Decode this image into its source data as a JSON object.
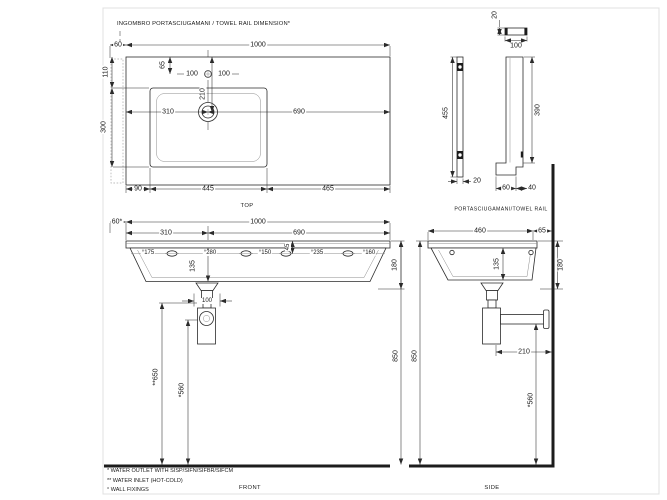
{
  "page": {
    "background": "#ffffff",
    "line_color": "#2b2b2b",
    "wall_color": "#1c1c1c"
  },
  "header": {
    "note": "INGOMBRO PORTASCIUGAMANI / TOWEL RAIL DIMENSION*"
  },
  "views": {
    "top": {
      "caption": "TOP"
    },
    "front": {
      "caption": "FRONT"
    },
    "side": {
      "caption": "SIDE"
    },
    "towel_rail": {
      "caption": "PORTASCIUGAMANI/TOWEL RAIL"
    }
  },
  "footnotes": [
    "* WATER OUTLET WITH SISP/SIFN/SIFBR/SIFCM",
    "** WATER INLET  (HOT-COLD)",
    "° WALL FIXINGS"
  ],
  "annotations": [
    {
      "t": "60",
      "x": 118,
      "y": 45
    },
    {
      "t": "1000",
      "x": 258,
      "y": 45
    },
    {
      "t": "110",
      "x": 106,
      "y": 72,
      "r": -90
    },
    {
      "t": "65",
      "x": 163,
      "y": 65,
      "r": -90
    },
    {
      "t": "100",
      "x": 192,
      "y": 74
    },
    {
      "t": "100",
      "x": 224,
      "y": 74
    },
    {
      "t": "210",
      "x": 203,
      "y": 94,
      "r": -90
    },
    {
      "t": "310",
      "x": 168,
      "y": 112
    },
    {
      "t": "690",
      "x": 299,
      "y": 112
    },
    {
      "t": "300",
      "x": 104,
      "y": 127,
      "r": -90
    },
    {
      "t": "90",
      "x": 138,
      "y": 189
    },
    {
      "t": "445",
      "x": 208,
      "y": 189
    },
    {
      "t": "465",
      "x": 328,
      "y": 189
    },
    {
      "t": "20",
      "x": 495,
      "y": 15,
      "r": -90
    },
    {
      "t": "100",
      "x": 516,
      "y": 46
    },
    {
      "t": "455",
      "x": 446,
      "y": 113,
      "r": -90
    },
    {
      "t": "20",
      "x": 477,
      "y": 181
    },
    {
      "t": "390",
      "x": 538,
      "y": 110,
      "r": -90
    },
    {
      "t": "60",
      "x": 506,
      "y": 188
    },
    {
      "t": "40",
      "x": 532,
      "y": 188
    },
    {
      "t": "60*",
      "x": 117,
      "y": 222
    },
    {
      "t": "1000",
      "x": 258,
      "y": 222
    },
    {
      "t": "310",
      "x": 166,
      "y": 233
    },
    {
      "t": "690",
      "x": 299,
      "y": 233
    },
    {
      "t": "°175",
      "x": 148,
      "y": 253,
      "s": 6
    },
    {
      "t": "°280",
      "x": 210,
      "y": 253,
      "s": 6
    },
    {
      "t": "°150",
      "x": 265,
      "y": 253,
      "s": 6
    },
    {
      "t": "45",
      "x": 288,
      "y": 247,
      "r": -90,
      "s": 6
    },
    {
      "t": "°235",
      "x": 317,
      "y": 253,
      "s": 6
    },
    {
      "t": "°160",
      "x": 369,
      "y": 253,
      "s": 6
    },
    {
      "t": "135",
      "x": 193,
      "y": 266,
      "r": -90
    },
    {
      "t": "180",
      "x": 395,
      "y": 265,
      "r": -90
    },
    {
      "t": "100",
      "x": 207,
      "y": 301,
      "s": 6
    },
    {
      "t": "**650",
      "x": 156,
      "y": 377,
      "r": -90
    },
    {
      "t": "*560",
      "x": 182,
      "y": 390,
      "r": -90
    },
    {
      "t": "850",
      "x": 396,
      "y": 356,
      "r": -90
    },
    {
      "t": "460",
      "x": 480,
      "y": 231
    },
    {
      "t": "65",
      "x": 542,
      "y": 231
    },
    {
      "t": "135",
      "x": 497,
      "y": 264,
      "r": -90
    },
    {
      "t": "180",
      "x": 561,
      "y": 265,
      "r": -90
    },
    {
      "t": "210",
      "x": 524,
      "y": 352
    },
    {
      "t": "*560",
      "x": 531,
      "y": 400,
      "r": -90
    },
    {
      "t": "850",
      "x": 415,
      "y": 356,
      "r": -90
    }
  ]
}
